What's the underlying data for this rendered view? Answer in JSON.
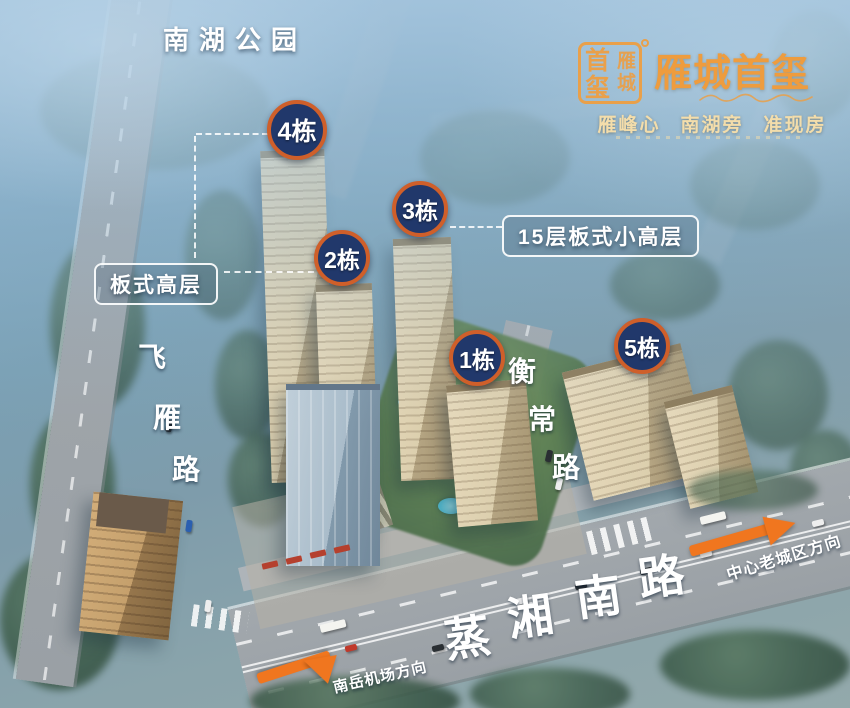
{
  "park_label": "南湖公园",
  "logo": {
    "seal_main": "首玺",
    "seal_main_chars": [
      "首",
      "玺"
    ],
    "seal_overlay_chars": [
      "雁",
      "城"
    ],
    "title": "雁城首玺",
    "slogan": [
      "雁峰心",
      "南湖旁",
      "准现房"
    ]
  },
  "badges": [
    {
      "id": "building-4",
      "label": "4栋"
    },
    {
      "id": "building-3",
      "label": "3栋"
    },
    {
      "id": "building-2",
      "label": "2栋"
    },
    {
      "id": "building-1",
      "label": "1栋"
    },
    {
      "id": "building-5",
      "label": "5栋"
    }
  ],
  "callouts": {
    "left": "板式高层",
    "right": "15层板式小高层"
  },
  "roads": {
    "feiyan": {
      "name": "飞雁路",
      "chars": [
        "飞",
        "雁",
        "路"
      ]
    },
    "hengchang": {
      "name": "衡常路",
      "chars": [
        "衡",
        "常",
        "路"
      ]
    },
    "zhengxiang": {
      "name": "蒸湘南路",
      "chars": [
        "蒸",
        "湘",
        "南",
        "路"
      ]
    }
  },
  "directions": {
    "right_arrow_label": "中心老城区方向",
    "left_arrow_label": "南岳机场方向"
  },
  "colors": {
    "badge_fill": "#21386b",
    "badge_ring": "#cf5f2a",
    "arrow_orange": "#f0761f",
    "logo_gold": "#e9a04a"
  }
}
